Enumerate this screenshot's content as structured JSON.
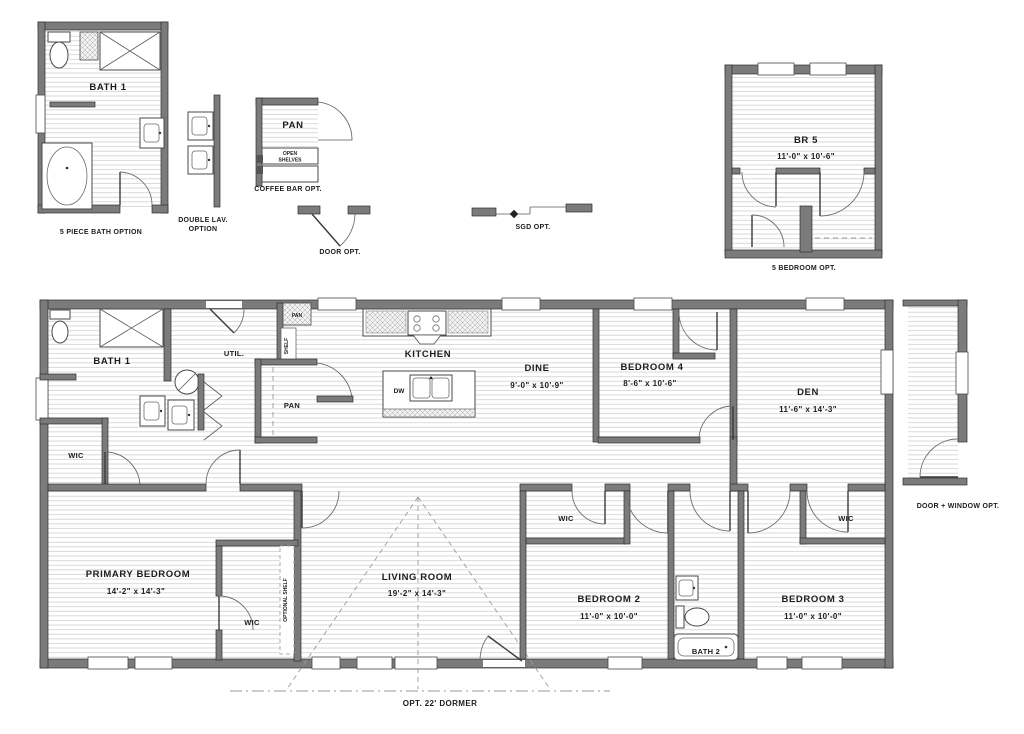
{
  "options": {
    "five_piece_bath": {
      "room_label": "BATH 1",
      "caption": "5 PIECE BATH OPTION"
    },
    "double_lav": {
      "caption_l1": "DOUBLE LAV.",
      "caption_l2": "OPTION"
    },
    "coffee_bar": {
      "room_label": "PAN",
      "shelves_l1": "OPEN",
      "shelves_l2": "SHELVES",
      "caption": "COFFEE BAR OPT."
    },
    "door": {
      "caption": "DOOR OPT."
    },
    "sgd": {
      "caption": "SGD OPT."
    },
    "five_bedroom": {
      "room_label": "BR 5",
      "room_dims": "11'-0\" x  10'-6\"",
      "caption": "5 BEDROOM OPT."
    },
    "door_window": {
      "caption": "DOOR + WINDOW OPT."
    },
    "dormer": {
      "caption": "OPT. 22' DORMER"
    }
  },
  "main_plan": {
    "bath1": "BATH 1",
    "util": "UTIL.",
    "pan_closet": "PAN",
    "shelf": "SHELF",
    "pantry": "PAN",
    "kitchen": "KITCHEN",
    "dw": "DW",
    "dine": {
      "name": "DINE",
      "dims": "9'-0\" x 10'-9\""
    },
    "bedroom4": {
      "name": "BEDROOM 4",
      "dims": "8'-6\" x 10'-6\""
    },
    "den": {
      "name": "DEN",
      "dims": "11'-6\" x 14'-3\""
    },
    "wic_hall": "WIC",
    "primary_bedroom": {
      "name": "PRIMARY BEDROOM",
      "dims": "14'-2\" x 14'-3\""
    },
    "wic_primary": "WIC",
    "optional_shelf": "OPTIONAL SHELF",
    "living_room": {
      "name": "LIVING ROOM",
      "dims": "19'-2\" x 14'-3\""
    },
    "wic_bedroom2": "WIC",
    "bedroom2": {
      "name": "BEDROOM 2",
      "dims": "11'-0\" x 10'-0\""
    },
    "bath2": "BATH 2",
    "wic_bedroom3": "WIC",
    "bedroom3": {
      "name": "BEDROOM 3",
      "dims": "11'-0\" x 10'-0\""
    }
  },
  "colors": {
    "wall": "#7b7b7b",
    "hatch": "#cfcfcf",
    "text": "#1c1c1c",
    "background": "#ffffff"
  }
}
